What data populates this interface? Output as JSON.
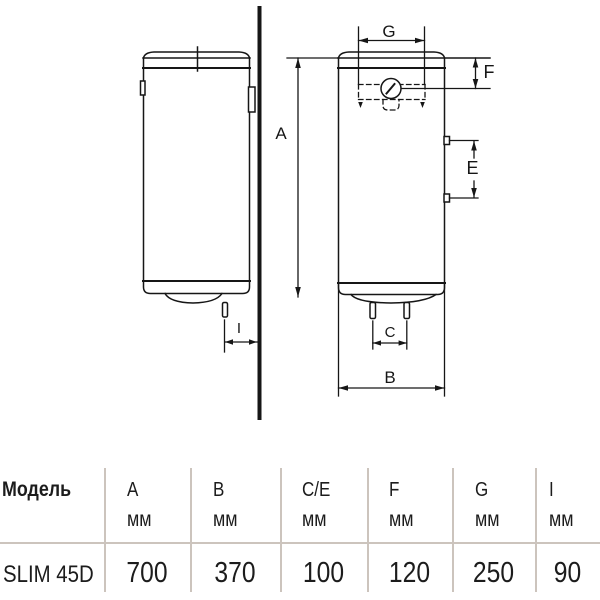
{
  "diagram": {
    "dimension_labels": {
      "A": "A",
      "B": "B",
      "C": "C",
      "E": "E",
      "F": "F",
      "G": "G",
      "I": "I"
    }
  },
  "table": {
    "model_column_header": "Модель",
    "columns": [
      {
        "letter": "A",
        "unit": "мм"
      },
      {
        "letter": "B",
        "unit": "мм"
      },
      {
        "letter": "C/E",
        "unit": "мм"
      },
      {
        "letter": "F",
        "unit": "мм"
      },
      {
        "letter": "G",
        "unit": "мм"
      },
      {
        "letter": "I",
        "unit": "мм"
      }
    ],
    "row": {
      "model": "SLIM 45D",
      "values": [
        "700",
        "370",
        "100",
        "120",
        "250",
        "90"
      ]
    }
  },
  "colors": {
    "drawing_line": "#161616",
    "table_line": "#ccc4bd",
    "background": "#ffffff"
  }
}
